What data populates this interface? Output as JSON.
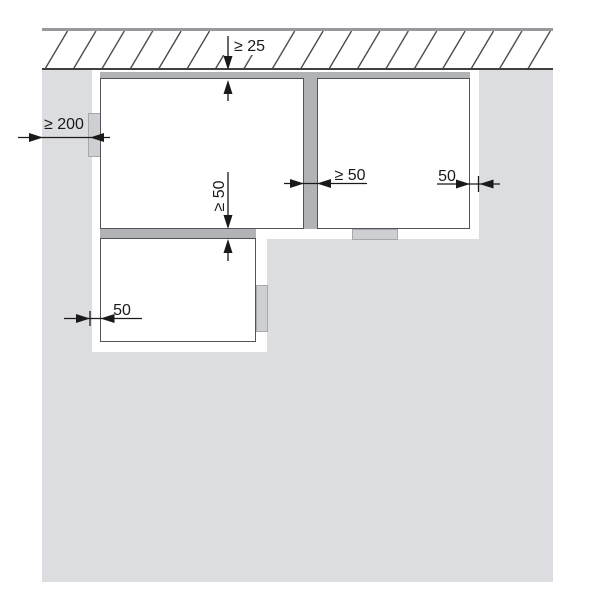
{
  "diagram": {
    "type": "installation-clearance-diagram",
    "dimensions": [
      {
        "id": "ceiling-clearance",
        "label": "≥ 25",
        "orientation": "vertical"
      },
      {
        "id": "left-wall-clearance",
        "label": "≥ 200",
        "orientation": "horizontal"
      },
      {
        "id": "between-units-clearance",
        "label": "≥ 50",
        "orientation": "horizontal"
      },
      {
        "id": "right-wall-clearance",
        "label": "50",
        "orientation": "horizontal"
      },
      {
        "id": "below-unit-clearance",
        "label": "≥ 50",
        "orientation": "vertical"
      },
      {
        "id": "lower-left-clearance",
        "label": "50",
        "orientation": "horizontal"
      }
    ],
    "colors": {
      "wall": "#dcdde0",
      "spacer_bar": "#b1b3b6",
      "mounting_tab": "#cdcfd2",
      "box_outline": "#515356",
      "ceiling_top_line": "#97999c",
      "hatch_line": "#404040",
      "dimension": "#1a1a1a"
    }
  }
}
